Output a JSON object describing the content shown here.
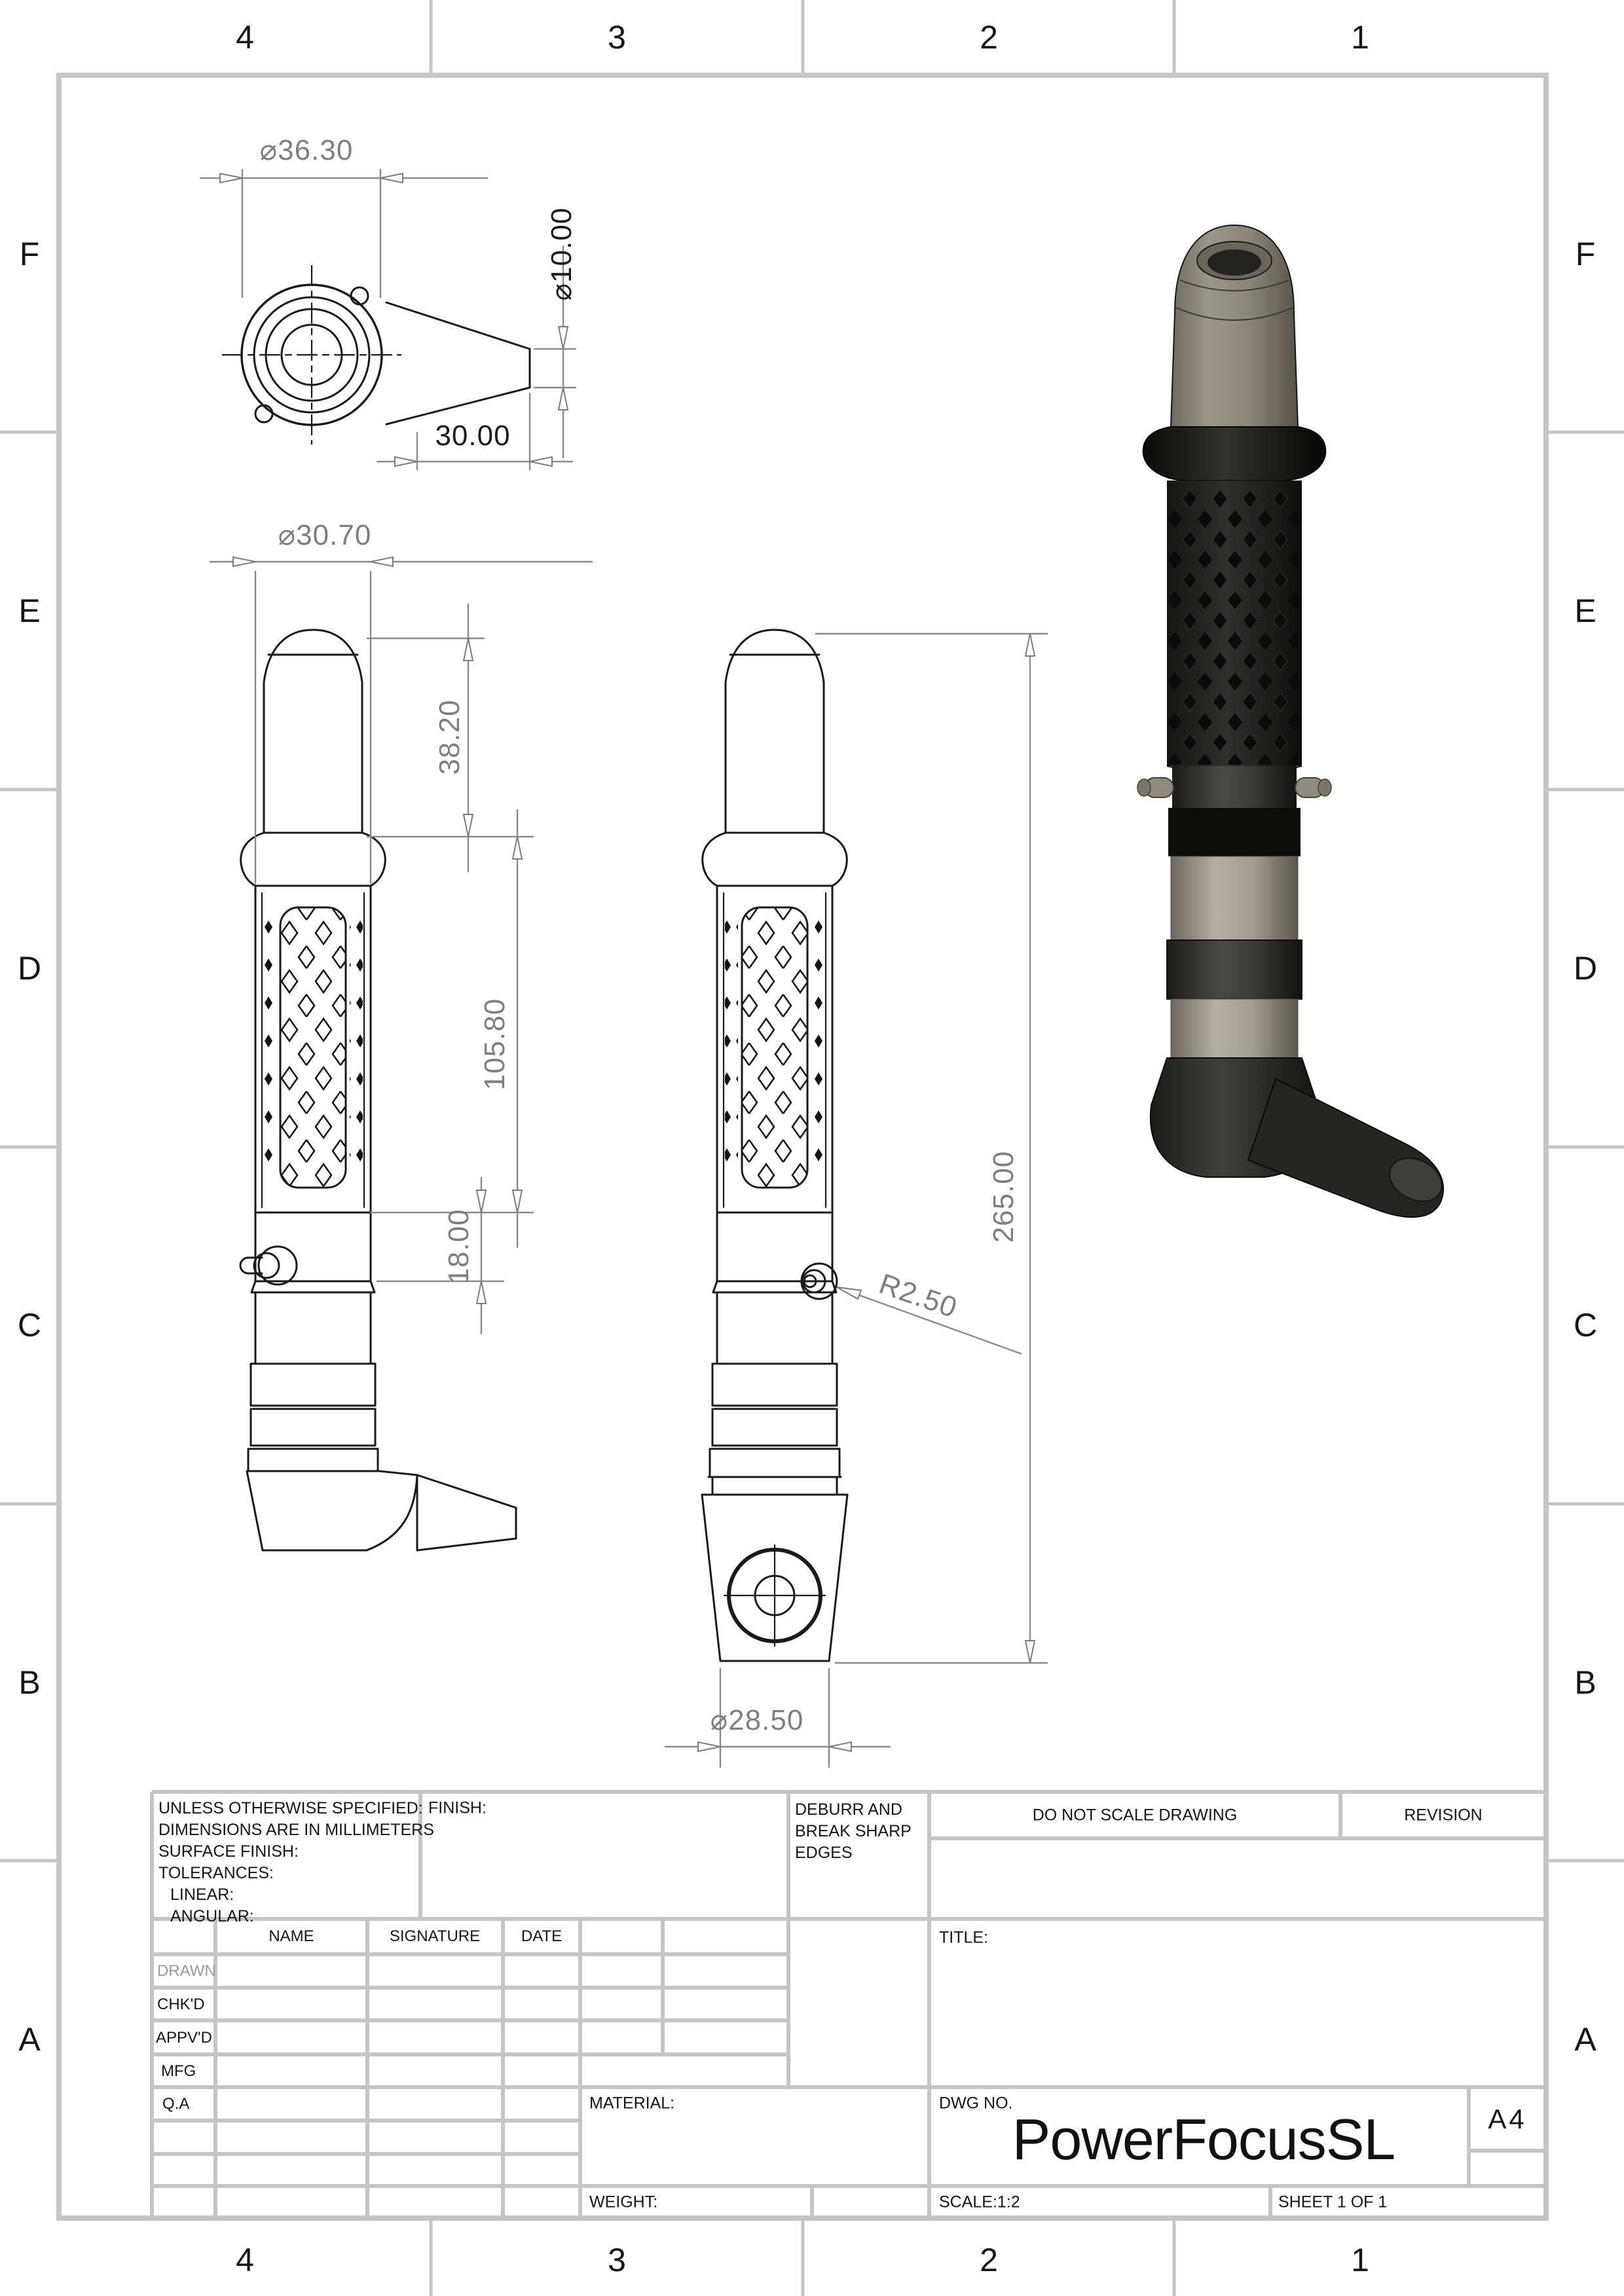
{
  "sheet": {
    "type": "engineering-drawing",
    "paper": "A4",
    "colors": {
      "frame_gray": "#c5c5c5",
      "dim_gray": "#8a8a8a",
      "dim_text_gray": "#7f7f7f",
      "line_black": "#1a1a1a",
      "model_cap_gray": "#8b8579",
      "model_band_gray": "#a29d92",
      "model_black": "#161614"
    }
  },
  "zones": {
    "columns": [
      "4",
      "3",
      "2",
      "1"
    ],
    "rows": [
      "F",
      "E",
      "D",
      "C",
      "B",
      "A"
    ]
  },
  "dimensions": {
    "top_view": {
      "flange_diameter": "⌀36.30",
      "nozzle_bore_diameter": "⌀10.00",
      "nozzle_length": "30.00"
    },
    "front_view": {
      "grip_diameter": "⌀30.70",
      "cap_length": "38.20",
      "grip_length": "105.80",
      "button_section_length": "18.00"
    },
    "side_view": {
      "overall_length": "265.00",
      "button_radius": "R2.50",
      "base_diameter": "⌀28.50"
    }
  },
  "title_block": {
    "tolerance_note": [
      "UNLESS OTHERWISE SPECIFIED:",
      "DIMENSIONS ARE IN MILLIMETERS",
      "SURFACE FINISH:",
      "TOLERANCES:",
      "LINEAR:",
      "ANGULAR:"
    ],
    "finish_label": "FINISH:",
    "deburr_note": "DEBURR AND BREAK SHARP EDGES",
    "do_not_scale": "DO NOT SCALE DRAWING",
    "revision_label": "REVISION",
    "title_label": "TITLE:",
    "columns": {
      "name": "NAME",
      "signature": "SIGNATURE",
      "date": "DATE"
    },
    "rows": [
      "DRAWN",
      "CHK'D",
      "APPV'D",
      "MFG",
      "Q.A"
    ],
    "material_label": "MATERIAL:",
    "weight_label": "WEIGHT:",
    "dwg_no_label": "DWG NO.",
    "dwg_no_value": "PowerFocusSL",
    "paper_size": "A4",
    "scale_label": "SCALE:1:2",
    "sheet_label": "SHEET 1 OF 1"
  }
}
